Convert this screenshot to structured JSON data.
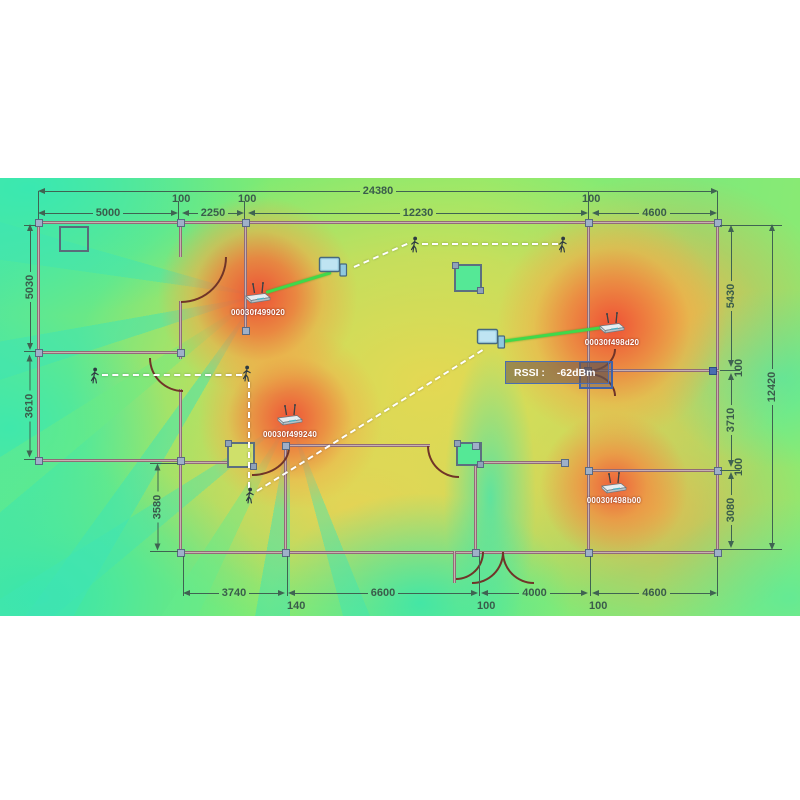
{
  "scene": {
    "type": "wifi-heatmap-floorplan",
    "description": "WiFi signal strength heatmap over building floor plan with access points, client laptops and walking survey paths"
  },
  "dims": {
    "top_total": "24380",
    "top_5000": "5000",
    "top_100a": "100",
    "top_2250": "2250",
    "top_100b": "100",
    "top_12230": "12230",
    "top_100c": "100",
    "top_4600": "4600",
    "left_5030": "5030",
    "left_3610": "3610",
    "left_3580": "3580",
    "right_5430": "5430",
    "right_100a": "100",
    "right_3710": "3710",
    "right_100b": "100",
    "right_3080": "3080",
    "right_total": "12420",
    "bottom_3740": "3740",
    "bottom_140": "140",
    "bottom_6600": "6600",
    "bottom_100a": "100",
    "bottom_4000": "4000",
    "bottom_100b": "100",
    "bottom_4600": "4600"
  },
  "access_points": [
    {
      "label": "00030f499020"
    },
    {
      "label": "00030f498d20"
    },
    {
      "label": "00030f499240"
    },
    {
      "label": "00030f498b00"
    }
  ],
  "tooltip": {
    "label": "RSSI :",
    "value": "-62dBm"
  },
  "colors": {
    "heat_scale": [
      "#3ee8ac",
      "#7dec75",
      "#c8ec62",
      "#ecd94f",
      "#f2a748",
      "#f2603a"
    ],
    "signal_line": "#3fd94a",
    "walk_path": "#ffffff",
    "dimension_text": "#3a5c4b",
    "tooltip_border": "#4a6db0"
  }
}
